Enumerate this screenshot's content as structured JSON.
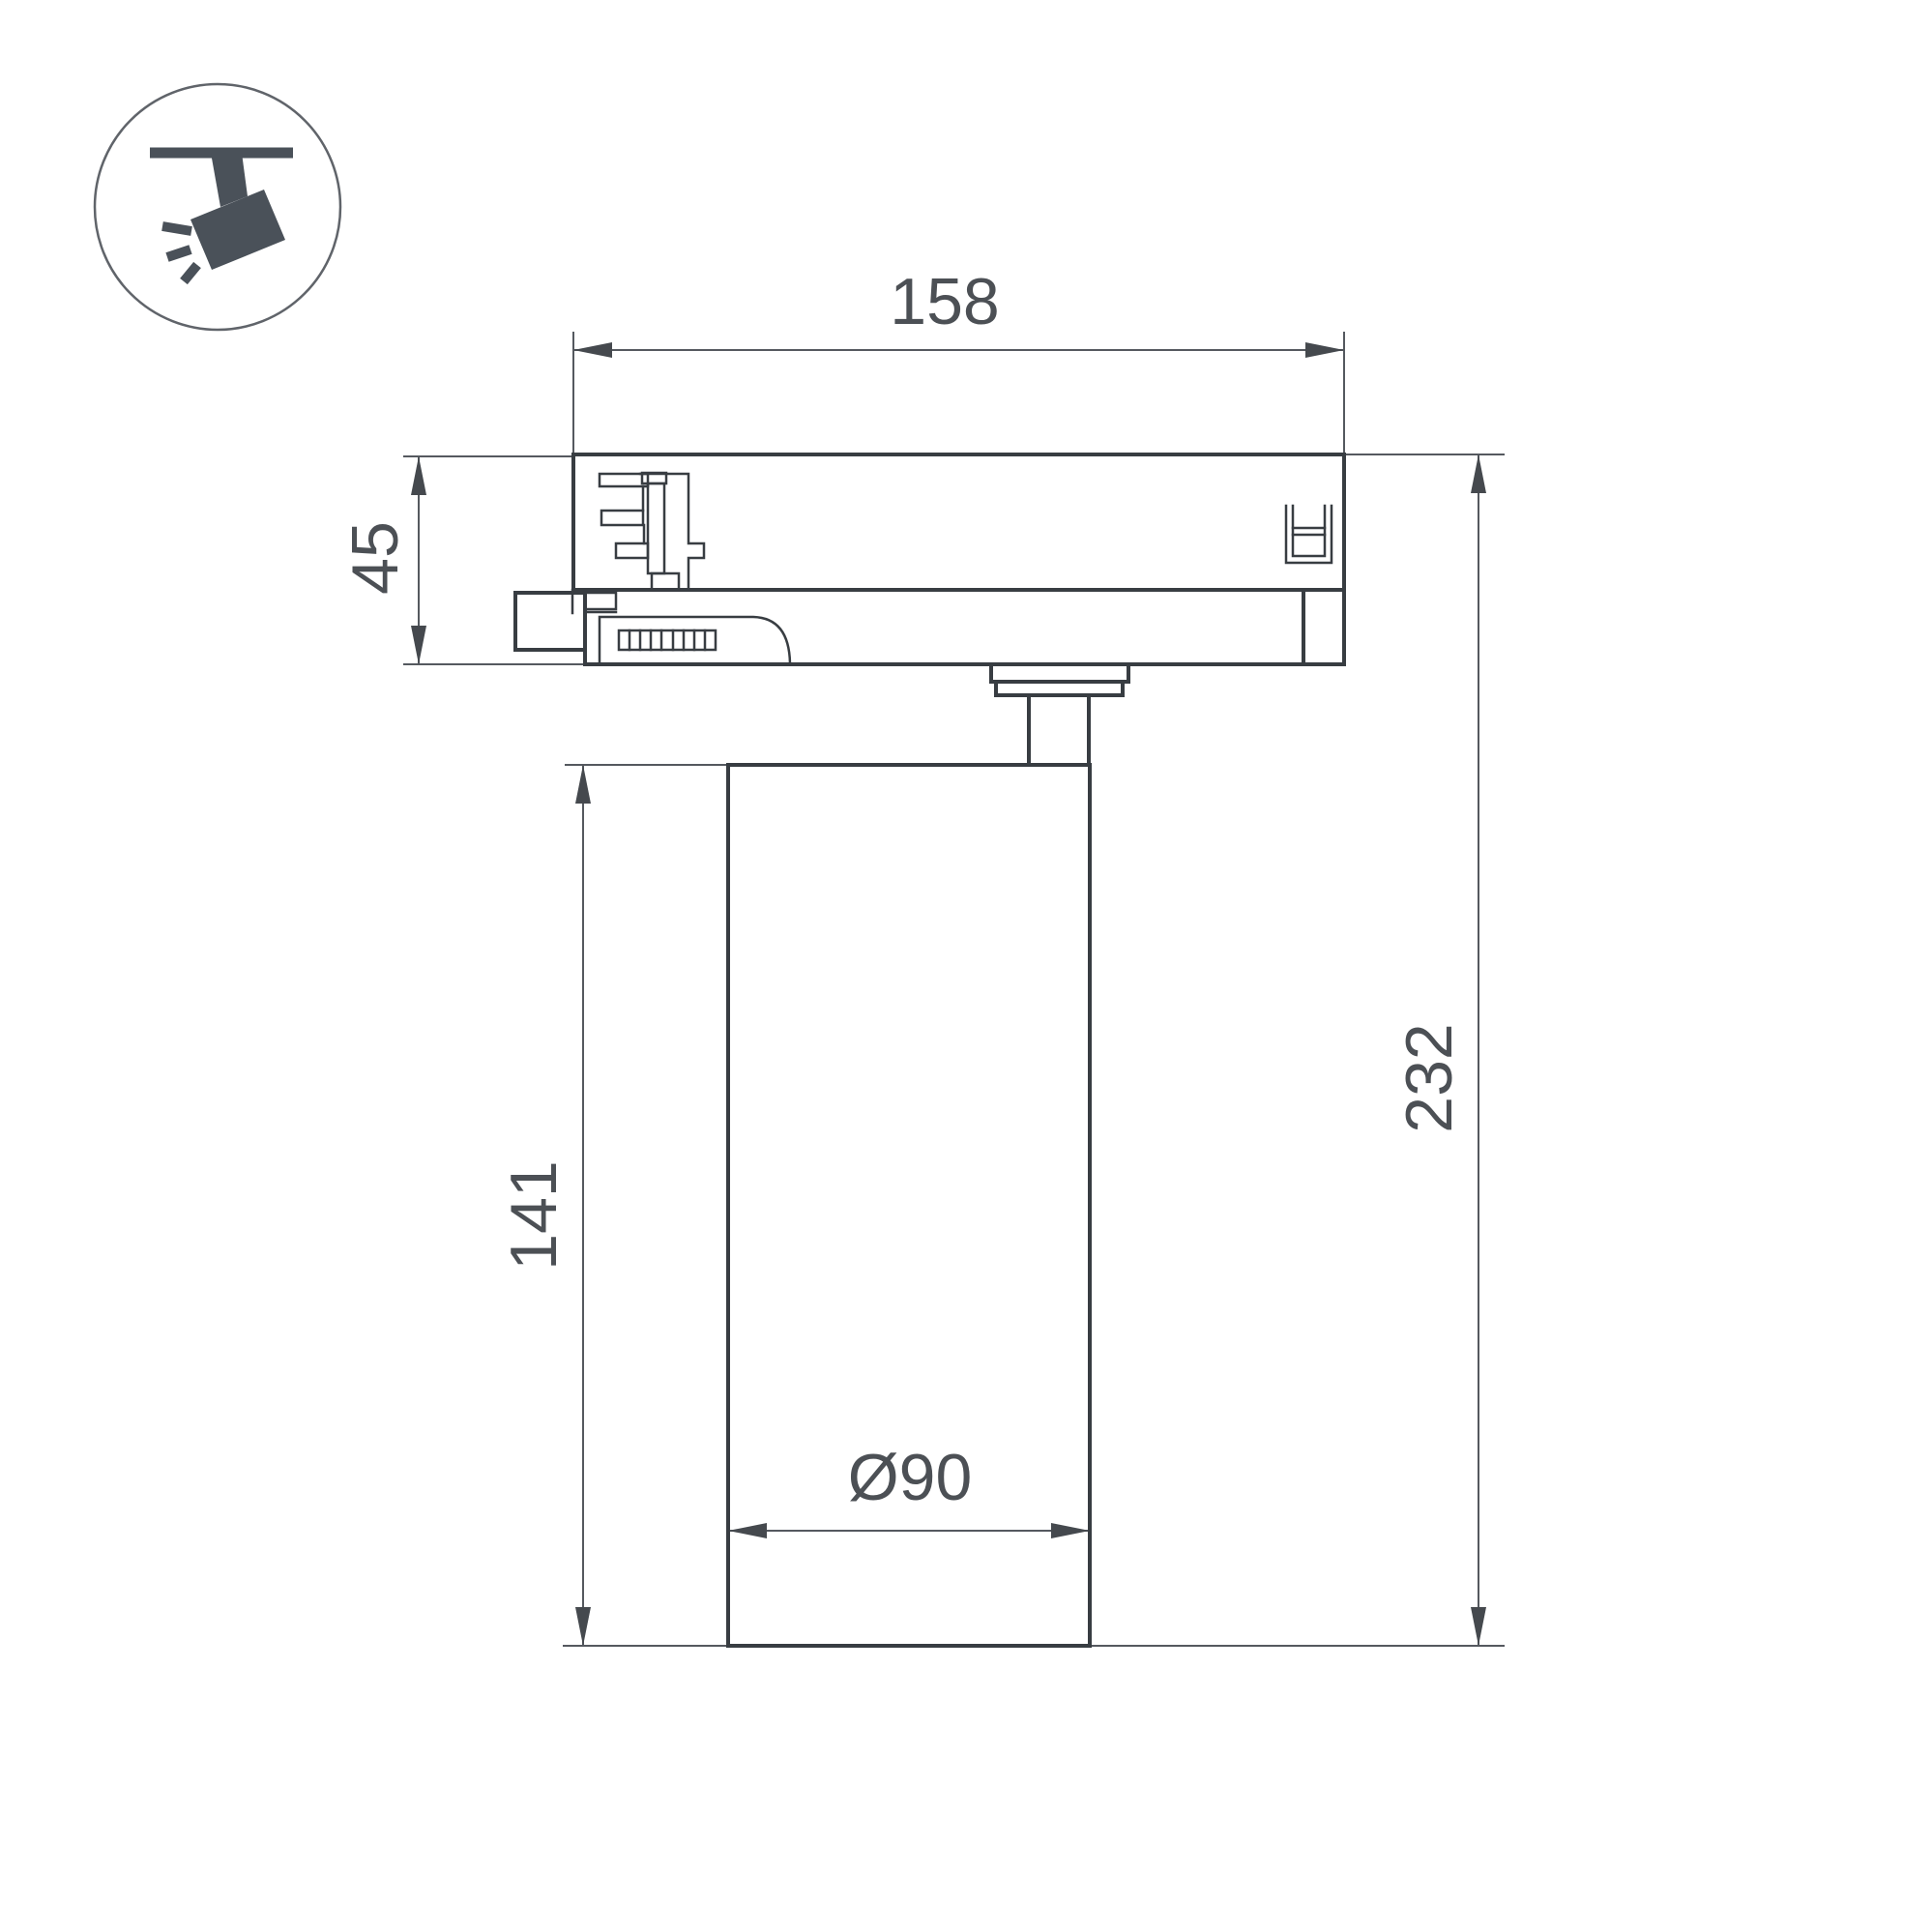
{
  "drawing": {
    "title": "ceiling track spotlight dimensional drawing",
    "background": "#ffffff",
    "colors": {
      "part_line": "#383d42",
      "dimension_line": "#55595f",
      "text": "#4c5055",
      "icon": "#4a5159"
    },
    "icon": {
      "name": "ceiling-track-spotlight"
    },
    "dimensions": {
      "adapter_width": {
        "label": "158"
      },
      "adapter_height": {
        "label": "45"
      },
      "body_height": {
        "label": "141"
      },
      "total_height": {
        "label": "232"
      },
      "body_diameter": {
        "label": "Ø90"
      }
    }
  }
}
